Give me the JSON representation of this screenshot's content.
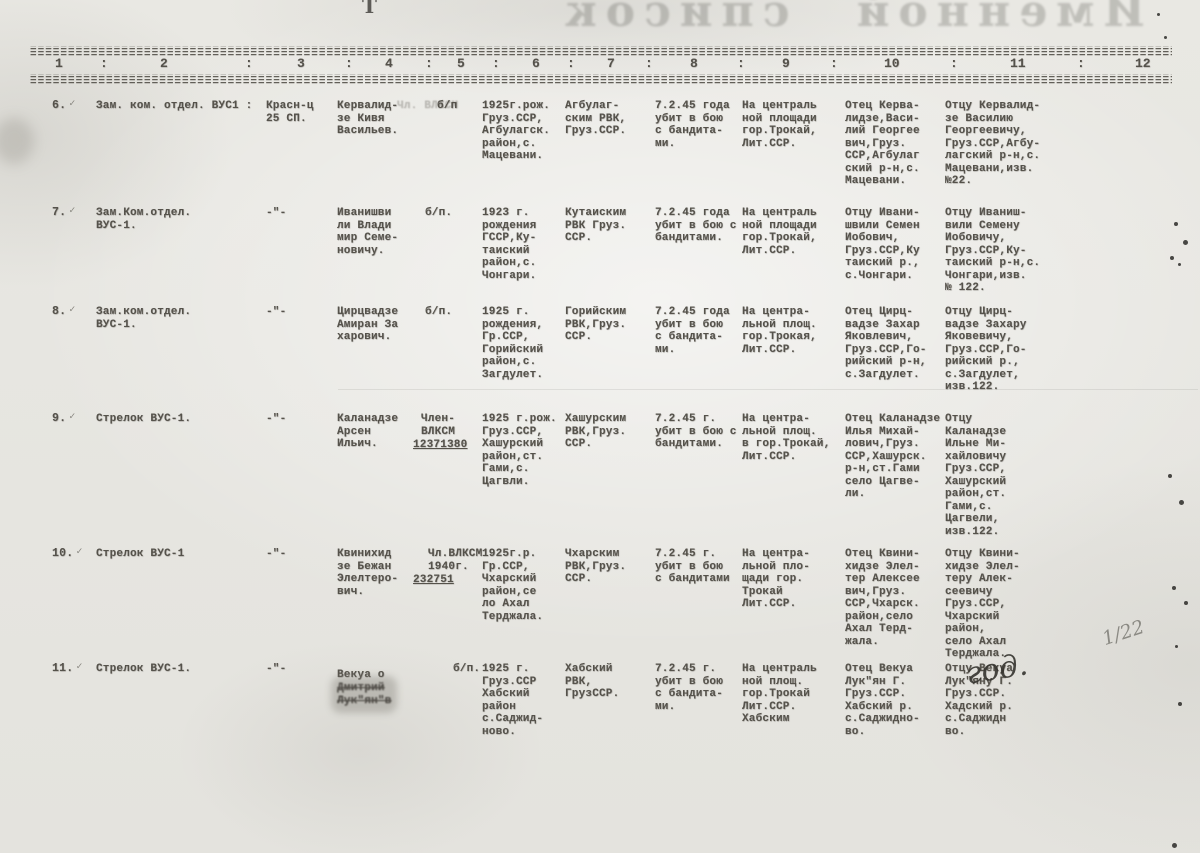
{
  "page": {
    "bleedthrough_title": "Именной список",
    "top_mark": "Т"
  },
  "header": {
    "columns": [
      "1",
      "2",
      "3",
      "4",
      "5",
      "6",
      "7",
      "8",
      "9",
      "10",
      "11",
      "12"
    ],
    "separator": ":"
  },
  "rows": [
    {
      "num": "6.",
      "check": "✓",
      "position": "Зам. ком. отдел. ВУС1 :",
      "unit": "Красн-ц\n25 СП.",
      "name": "Кервалид-\nзе Кивя\nВасильев.",
      "ghost": "Чл. ВЛКСМ",
      "party": "б/п",
      "birth": "1925г.рож.\nГруз.ССР,\nАгбулагск.\nрайон,с.\nМацевани.",
      "rvk": "Агбулаг-\nским РВК,\nГруз.ССР.",
      "death": "7.2.45 года\nубит в бою\nс бандита-\nми.",
      "burial": "На централь\nной площади\nгор.Трокай,\nЛит.ССР.",
      "father": "Отец Керва-\nлидзе,Васи-\nлий Георгее\nвич,Груз.\nССР,Агбулаг\nский р-н,с.\nМацевани.",
      "notify": "Отцу Кервалид-\nзе Василию\nГеоргеевичу,\nГруз.ССР,Агбу-\nлагский р-н,с.\nМацевани,изв.\n№22."
    },
    {
      "num": "7.",
      "check": "✓",
      "position": "Зам.Ком.отдел.\nВУС-1.",
      "unit": "-\"-",
      "name": "Иванишви\nли Влади\nмир Семе-\nновичу.",
      "party": "б/п.",
      "birth": "1923 г.\nрождения\nГССР,Ку-\nтаиский\nрайон,с.\nЧонгари.",
      "rvk": "Кутаиским\nРВК Груз.\nССР.",
      "death": "7.2.45 года\nубит в бою с\nбандитами.",
      "burial": "На централь\nной площади\nгор.Трокай,\nЛит.ССР.",
      "father": "Отцу Ивани-\nшвили Семен\nИобович,\nГруз.ССР,Ку\nтаиский р.,\nс.Чонгари.",
      "notify": "Отцу Иваниш-\nвили Семену\nИобовичу,\nГруз.ССР,Ку-\nтаиский р-н,с.\nЧонгари,изв.\n№ 122."
    },
    {
      "num": "8.",
      "check": "✓",
      "position": "Зам.ком.отдел.\nВУС-1.",
      "unit": "-\"-",
      "name": "Цирцвадзе\nАмиран За\nхарович.",
      "party": "б/п.",
      "birth": "1925 г.\nрождения,\nГр.ССР,\nГорийский\nрайон,с.\nЗагдулет.",
      "rvk": "Горийским\nРВК,Груз.\nССР.",
      "death": "7.2.45 года\nубит в бою\nс бандита-\nми.",
      "burial": "На центра-\nльной площ.\nгор.Трокая,\nЛит.ССР.",
      "father": "Отец Цирц-\nвадзе Захар\nЯковлевич,\nГруз.ССР,Го-\nрийский р-н,\nс.Загдулет.",
      "notify": "Отцу Цирц-\nвадзе Захару\nЯковевичу,\nГруз.ССР,Го-\nрийский р.,\nс.Загдулет,\nизв.122."
    },
    {
      "num": "9.",
      "check": "✓",
      "position": "Стрелок ВУС-1.",
      "unit": "-\"-",
      "name": "Каланадзе\nАрсен\nИльич.",
      "party": "Член-\nВЛКСМ",
      "party_num": "12371380",
      "birth": "1925 г.рож.\nГруз.ССР,\nХашурский\nрайон,ст.\nГами,с.\nЦагвли.",
      "rvk": "Хашурским\nРВК,Груз.\nССР.",
      "death": "7.2.45 г.\nубит в бою с\nбандитами.",
      "burial": "На центра-\nльной площ.\nв гор.Трокай,\nЛит.ССР.",
      "father": "Отец Каланадзе\nИлья Михай-\nлович,Груз.\nССР,Хашурск.\nр-н,ст.Гами\nсело Цагве-\nли.",
      "notify": "Отцу\nКаланадзе\nИльне Ми-\nхайловичу\nГруз.ССР,\nХашурский\nрайон,ст.\nГами,с.\nЦагвели,\nизв.122."
    },
    {
      "num": "10.",
      "check": "✓",
      "position": "Стрелок ВУС-1",
      "unit": "-\"-",
      "name": "Квинихид\nзе Бежан\nЭлелтеро-\nвич.",
      "party": "Чл.ВЛКСМ\n1940г.",
      "party_num": "232751",
      "birth": "1925г.р.\nГр.ССР,\nЧхарский\nрайон,се\nло Ахал\nТерджала.",
      "rvk": "Чхарским\nРВК,Груз.\nССР.",
      "death": "7.2.45 г.\nубит в бою\nс бандитами",
      "burial": "На центра-\nльной пло-\nщади гор.\nТрокай\nЛит.ССР.",
      "father": "Отец Квини-\nхидзе Элел-\nтер Алексее\nвич,Груз.\nССР,Чхарск.\nрайон,село\nАхал Терд-\nжала.",
      "notify": "Отцу Квини-\nхидзе Элел-\nтеру Алек-\nсеевичу\nГруз.ССР,\nЧхарский\nрайон,\nсело Ахал\nТерджала."
    },
    {
      "num": "11.",
      "check": "✓",
      "position": "Стрелок ВУС-1.",
      "unit": "-\"-",
      "name": "Векуа о",
      "name_smudged": "Дмитрий\nЛук\"ян\"в",
      "party": "б/п.",
      "birth": "1925 г.\nГруз.ССР\nХабский\nрайон\nс.Саджид-\nново.",
      "rvk": "Хабский\nРВК,\nГрузССР.",
      "death": "7.2.45 г.\nубит в бою\nс бандита-\nми.",
      "burial": "На централь\nной площ.\nгор.Трокай\nЛит.ССР.\nХабским",
      "father": "Отец Векуа\nЛук\"ян Г.\nГруз.ССР.\nХабский р.\nс.Саджидно-\nво.",
      "notify": "Отцу Векуа\nЛук\"яну Г.\nГруз.ССР.\nХадский р.\nс.Саджидн\nво."
    }
  ],
  "annotations": {
    "pencil_note": "1/22",
    "ink_note": "год."
  },
  "colors": {
    "paper": "#e7e6e2",
    "ink": "#55524b",
    "pencil": "#7d7c76"
  }
}
